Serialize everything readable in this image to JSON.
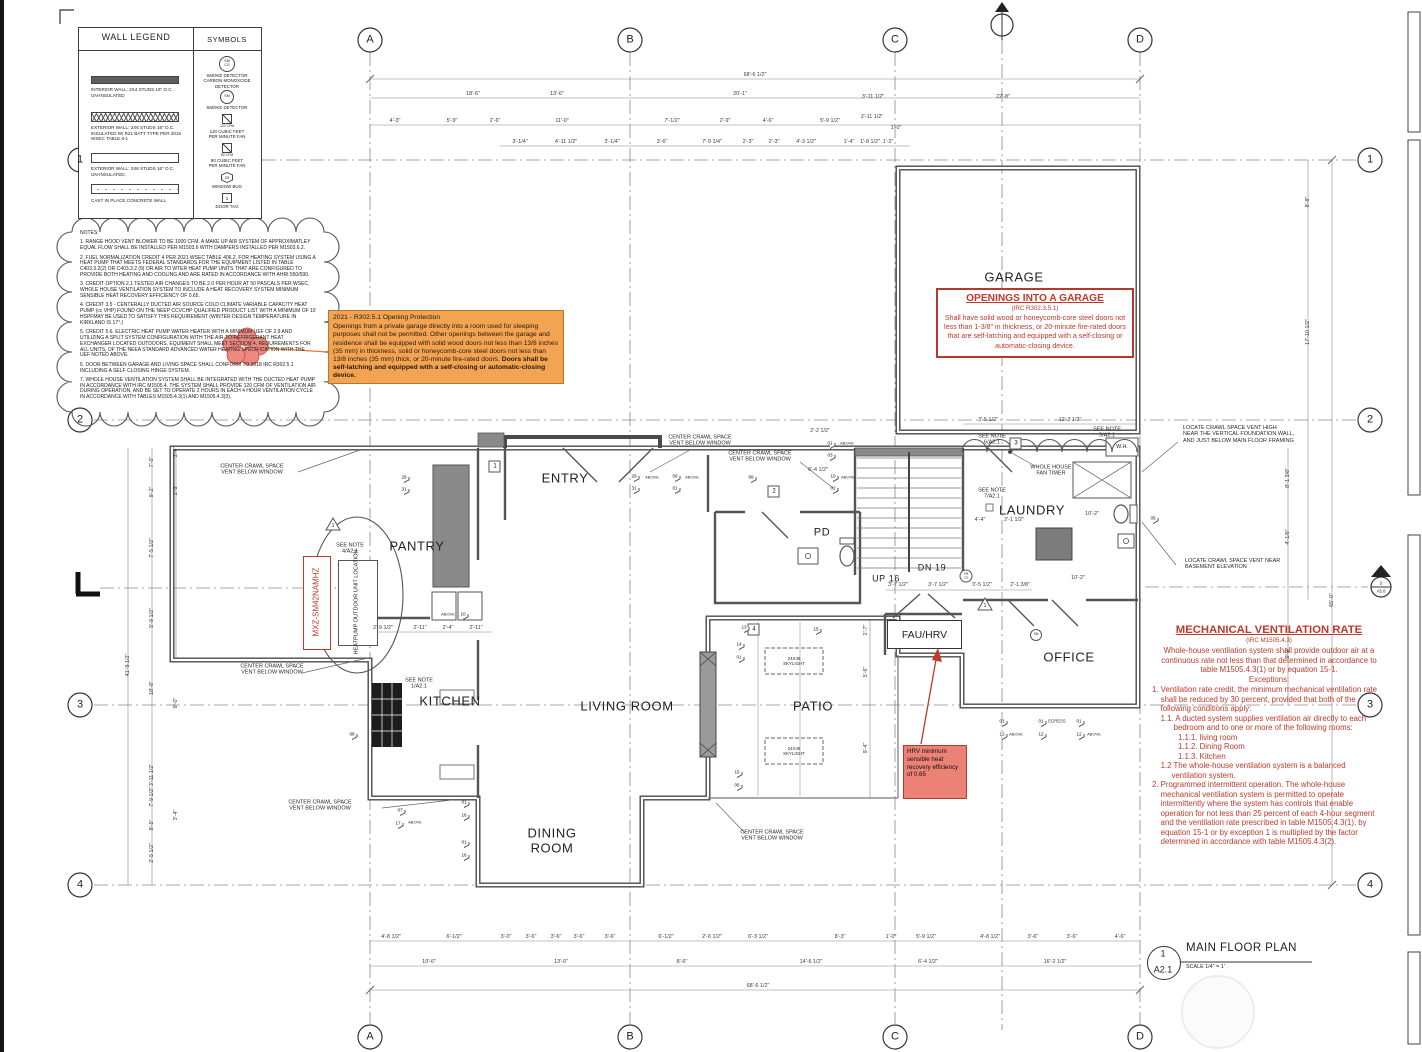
{
  "grid": {
    "cols": [
      "A",
      "B",
      "C",
      "D"
    ],
    "rows": [
      "1",
      "2",
      "3",
      "4"
    ]
  },
  "title_block": {
    "number": "1",
    "sheet": "A2.1",
    "title": "MAIN FLOOR PLAN",
    "scale": "SCALE 1/4\" = 1'"
  },
  "legend": {
    "title": "WALL LEGEND",
    "symbols_title": "SYMBOLS",
    "walls": [
      "INTERIOR WALL: 2X4 STUDS 16\" O.C.\nUN-INSULATED",
      "EXTERIOR WALL: 2X6 STUDS 16\" O.C.\nINSULATED W/ R21 BATT TYPE PER 2015\nWSEC TABLE 6-1",
      "EXTERIOR WALL: 2X6 STUDS 16\" O.C.\nUN-INSULATED,",
      "CAST IN PLACE CONCRETE WALL"
    ],
    "symbols": [
      {
        "glyph": "SM\nCO",
        "label": "SMOKE DETECTOR\nCARBON MONOXCIDE\nDETECTOR"
      },
      {
        "glyph": "SM",
        "label": "SMOKE DETECTOR"
      },
      {
        "caption": "120 CFM",
        "label": "120 CUBIC FEET\nPER MINUTE FAN"
      },
      {
        "caption": "80 CFM",
        "label": "80 CUBIC FEET\nPER MINUTE FAN"
      },
      {
        "glyph": "23",
        "label": "WINDOW BUG"
      },
      {
        "glyph": "1",
        "label": "DOOR TAG"
      }
    ]
  },
  "notes": {
    "heading": "NOTES:",
    "items": [
      "1. RANGE HOOD VENT BLOWER TO BE 1000 CFM. A MAKE UP AIR SYSTEM OF APPROXIMATLEY EQUAL FLOW SHALL BE INSTALLED PER M1503.6 WITH DAMPERS INSTALLED PER M1503.6.2.",
      "2. FUEL NORMALIZATION CREDIT 4 PER 2021 WSEC TABLE 406.2. FOR HEATING SYSTEM USING A HEAT PUMP THAT MEETS FEDERAL STANDARDS FOR THE EQUIPMENT LISTED IN TABLE C403.3.2(2) OR C403.3.2 (9) OR AIR TO WTER HEAT PUMP UNITS THAT ARE CONFIGURED TO PROVIDE BOTH HEATING AND COOLING AND ARE RATED IN ACCORDANCE WITH AHRI 550/590.",
      "3. CREDIT OPTION 2.1 TESTED AIR CHANGES TO BE 2.0 PER HOUR AT 50 PASCALS PER WSEC. WHOLE HOUSE VENTILATION SYSTEM TO INCLUDE A HEAT RECOVERY SYSTEM MINIMUM SENSIBLE HEAT RECOVERY EFFICIENCY OF 0.65.",
      "4. CREDIT 3.5 - CENTERALLY DUCTED AIR SOURCE COLD CLIMATE VARIABLE CAPACITY HEAT PUMP (cc VHP) FOUND ON THE NEEP CCVCHP QUALIFIED PRODUCT LIST WITH A MINIMUM OF 10 HSPFMAY BE USED TO SATISFY THIS REQUIREMENT (WINTER DESIGN TEMPERATURE IN KIRKLAND IS 17°.)",
      "5. CREDIT 5.6. ELECTRIC HEAT PUMP WATER HEATER WITH A MINIMUM UEF OF 2.9 AND UTILIZING A SPLIT SYSTEM CONFIGURATION WITH THE AIR-TO-REFRIGERANT HEAT EXCHANGER LOCATED OUTDOORS. EQUIMENT SHALL MEET SECTION 4, REQUIREMENTS FOR ALL UNITS, OF THE NEEA STANDARD ADVANCED WATER HEATING SPECIFICATION WITH THE UEF NOTED ABOVE.",
      "6. DOOR BETWEEN GARAGE AND LIVING SPACE SHALL CONFORM TO 2018 IRC R302.5.1 INCLUDING A SELF CLOSING HINGE SYSTEM.",
      "7. WHOLE HOUSE VENTILATION SYSTEM SHALL BE INTEGRATED WITH THE DUCTED HEAT PUMP IN ACCORDANCE WITH IRC M1505.4. THE SYSTEM SHALL PROVIDE 120 CFM OF VENTILATION AIR DURING OPERATION, AND BE SET TO OPERATE 2 HOURS IN EACH 4 HOUR VENTILATION CYCLE IN ACCORDANCE WITH TABLES M1505.4.3(1) AND M1505.4.3(3)."
    ]
  },
  "opening_protection": {
    "title": "2021 - R302.5.1 Opening Protection",
    "body": "Openings from a private garage directly into a room used for sleeping purposes shall not be permitted. Other openings between the garage and residence shall be equipped with solid wood doors not less than 13/8 inches (35 mm) in thickness, solid or honeycomb-core steel doors not less than 13/8 inches (35 mm) thick, or 20-minute fire-rated doors. ",
    "body_bold": "Doors shall be self-latching and equipped with a self-closing or automatic-closing device."
  },
  "garage_openings": {
    "title": "OPENINGS INTO A GARAGE",
    "code": "(IRC R302.3.5.1)",
    "body": "Shall have solid wood or honeycomb-core steel doors not less than 1-3/8\" in thickness, or 20-minute fire-rated doors that are self-latching and equipped with a self-closing or automatic-closing device."
  },
  "mech_vent": {
    "title": "MECHANICAL VENTILATION RATE",
    "code": "(IRC M1505.4.3)",
    "intro": "Whole-house ventilation system shall provide outdoor air at a\ncontinuous rate not less than that determined in accordance to\ntable M1505.4.3(1) or by equation 15-1.\nExceptions:",
    "body": "1. Ventilation rate credit. the minimum mechanical ventilation rate\n    shall be reduced by 30 percent, provided that both of the\n    following conditions apply:\n    1.1. A ducted system supplies ventilation air directly to each\n          bedroom and to one or more of the following rooms:\n            1.1.1. living room\n            1.1.2. Dining Room\n            1.1.3. Kitchen\n    1.2 The whole-house ventilation system is a balanced\n         ventilation system.\n2. Programmed intermittent operation. The whole-house\n    mechanical ventilation system is permitted to operate\n    intermittently where the system has controls that enable\n    operation for not less than 25 percent of each 4-hour segment\n    and the ventilation rate prescribed in table M1505.4.3(1), by\n    equation 15-1 or by exception 1 is multiplied by the factor\n    determined in accordance with table M1505.4.3(2)."
  },
  "hrv_note": "HRV minimum sensible heat recovery efficiency of 0.65",
  "rooms": {
    "garage": "GARAGE",
    "entry": "ENTRY",
    "pantry": "PANTRY",
    "kitchen": "KITCHEN",
    "living": "LIVING ROOM",
    "dining": "DINING\nROOM",
    "patio": "PATIO",
    "laundry": "LAUNDRY",
    "office": "OFFICE",
    "powder": "PD",
    "fau": "FAU/HRV",
    "up": "UP 16",
    "dn": "DN 19",
    "wh": "W.H."
  },
  "annotations": {
    "center_crawl": "CENTER CRAWL SPACE\nVENT BELOW WINDOW",
    "locate_high": "LOCATE CRAWL SPACE VENT HIGH\nNEAR THE VERTICAL FOUNDATION WALL,\nAND JUST BELOW MAIN FLOOR FRAMING",
    "locate_basement": "LOCATE CRAWL SPACE VENT NEAR\nBASEMENT ELEVATION",
    "fan_timer": "WHOLE HOUSE\nFAN TIMER",
    "see_note_1": "SEE NOTE\n1/A2.1",
    "see_note_4": "SEE NOTE\n4/A2.1",
    "see_note_5": "SEE NOTE\n5/A2.1",
    "see_note_6": "SEE NOTE\n6/A2.1",
    "see_note_7": "SEE NOTE\n7/A2.1",
    "heatpump": "HEATPUMP\nOUTDOOR\nUNIT LOCATION",
    "model": "MXZ-SM42NAMHZ",
    "skylight": "24X48\nSKYLIGHT",
    "egress": "EGRESS",
    "above": "ABOVE"
  },
  "plan": {
    "door_tags": [
      "1",
      "2",
      "3",
      "4"
    ],
    "triangle_tag": "1",
    "bugs": [
      "29",
      "31",
      "09",
      "01",
      "89",
      "10",
      "02",
      "01",
      "03",
      "29",
      "31",
      "08",
      "01",
      "16",
      "01",
      "16",
      "07",
      "17",
      "13",
      "15",
      "14",
      "01",
      "15",
      "06",
      "01",
      "12",
      "01",
      "12",
      "01",
      "12",
      "10",
      "05"
    ],
    "sm": "SM",
    "smco": "SM\nCO",
    "section_marker": {
      "number": "2",
      "sheet": "A5.0"
    }
  },
  "dims": {
    "top_overall": "68'-6 1/2\"",
    "top_mid": [
      "18'-6\"",
      "13'-6\"",
      "20'-1\"",
      "3'-11 1/2\"",
      "22'-8\""
    ],
    "top_detail": [
      "4'-3\"",
      "5'-9\"",
      "2'-6\"",
      "11'-0\"",
      "7'-1/2\"",
      "2'-9\"",
      "4'-6\"",
      "5'-9 1/2\"",
      "2'-11 1/2\"",
      "1'-0\""
    ],
    "top_fine": [
      "3'-1/4\"",
      "4'-11 1/2\"",
      "3'-1/4\"",
      "3'-6\"",
      "7'-9 1/4\"",
      "2'-3\"",
      "2'-3\"",
      "4'-3 1/2\"",
      "1'-4\"",
      "1'-8 1/2\"",
      "1'-2\""
    ],
    "bottom_detail": [
      "4'-8 1/2\"",
      "6'-1/2\"",
      "3'-0\"",
      "3'-6\"",
      "3'-6\"",
      "3'-6\"",
      "3'-6\"",
      "6'-1/2\"",
      "2'-6 1/2\"",
      "6'-3 1/2\"",
      "8'-3\"",
      "1'-0\"",
      "5'-9 1/2\"",
      "4'-8 1/2\"",
      "3'-6\"",
      "3'-6\"",
      "4'-6\""
    ],
    "bottom_mid": [
      "10'-6\"",
      "13'-0\"",
      "8'-6\"",
      "14'-6 1/2\"",
      "6'-4 1/2\"",
      "16'-2 1/2\""
    ],
    "bottom_overall": "68'-6 1/2\"",
    "left_overall": "41'-9 1/2\"",
    "left_col": [
      "7'-0\"",
      "9'-2\"",
      "7'-5 1/2\"",
      "5'-9 1/2\"",
      "18'-8\"",
      "3'-11 1/2\"",
      "7'-9 1/2\"",
      "8'-5\"",
      "2'-5 1/2\""
    ],
    "left_col2": [
      "3'-4\"",
      "2'-5\"",
      "9'-0\"",
      "3'-4\""
    ],
    "right_col": [
      "8'-8\"",
      "17'-10 1/2\"",
      "8'-1 3/8\"",
      "4'-1/8\"",
      "9'-2\""
    ],
    "right_overall": "65'-0\"",
    "garage": [
      "3'-5 1/2\"",
      "12'-3 1/2\""
    ],
    "fau_row": [
      "3'-7 1/2\"",
      "3'-7 1/2\"",
      "3'-5 1/2\"",
      "2'-1 3/8\""
    ],
    "kitchen_row": [
      "2'-9 1/2\"",
      "2'-11\"",
      "2'-4\"",
      "2'-11\""
    ],
    "laundry": [
      "4'-4\"",
      "2'-1 1/2\"",
      "10'-2\"",
      "10'-2\""
    ],
    "entry_right": [
      "2'-2 1/2\"",
      "6'-4 1/2\""
    ],
    "patio_col": [
      "2'-7\"",
      "5'-6\"",
      "9'-4\""
    ]
  },
  "colors": {
    "accent_red": "#c0392b",
    "highlight_orange": "#f29f4a",
    "cloud_salmon": "#ec8176"
  }
}
